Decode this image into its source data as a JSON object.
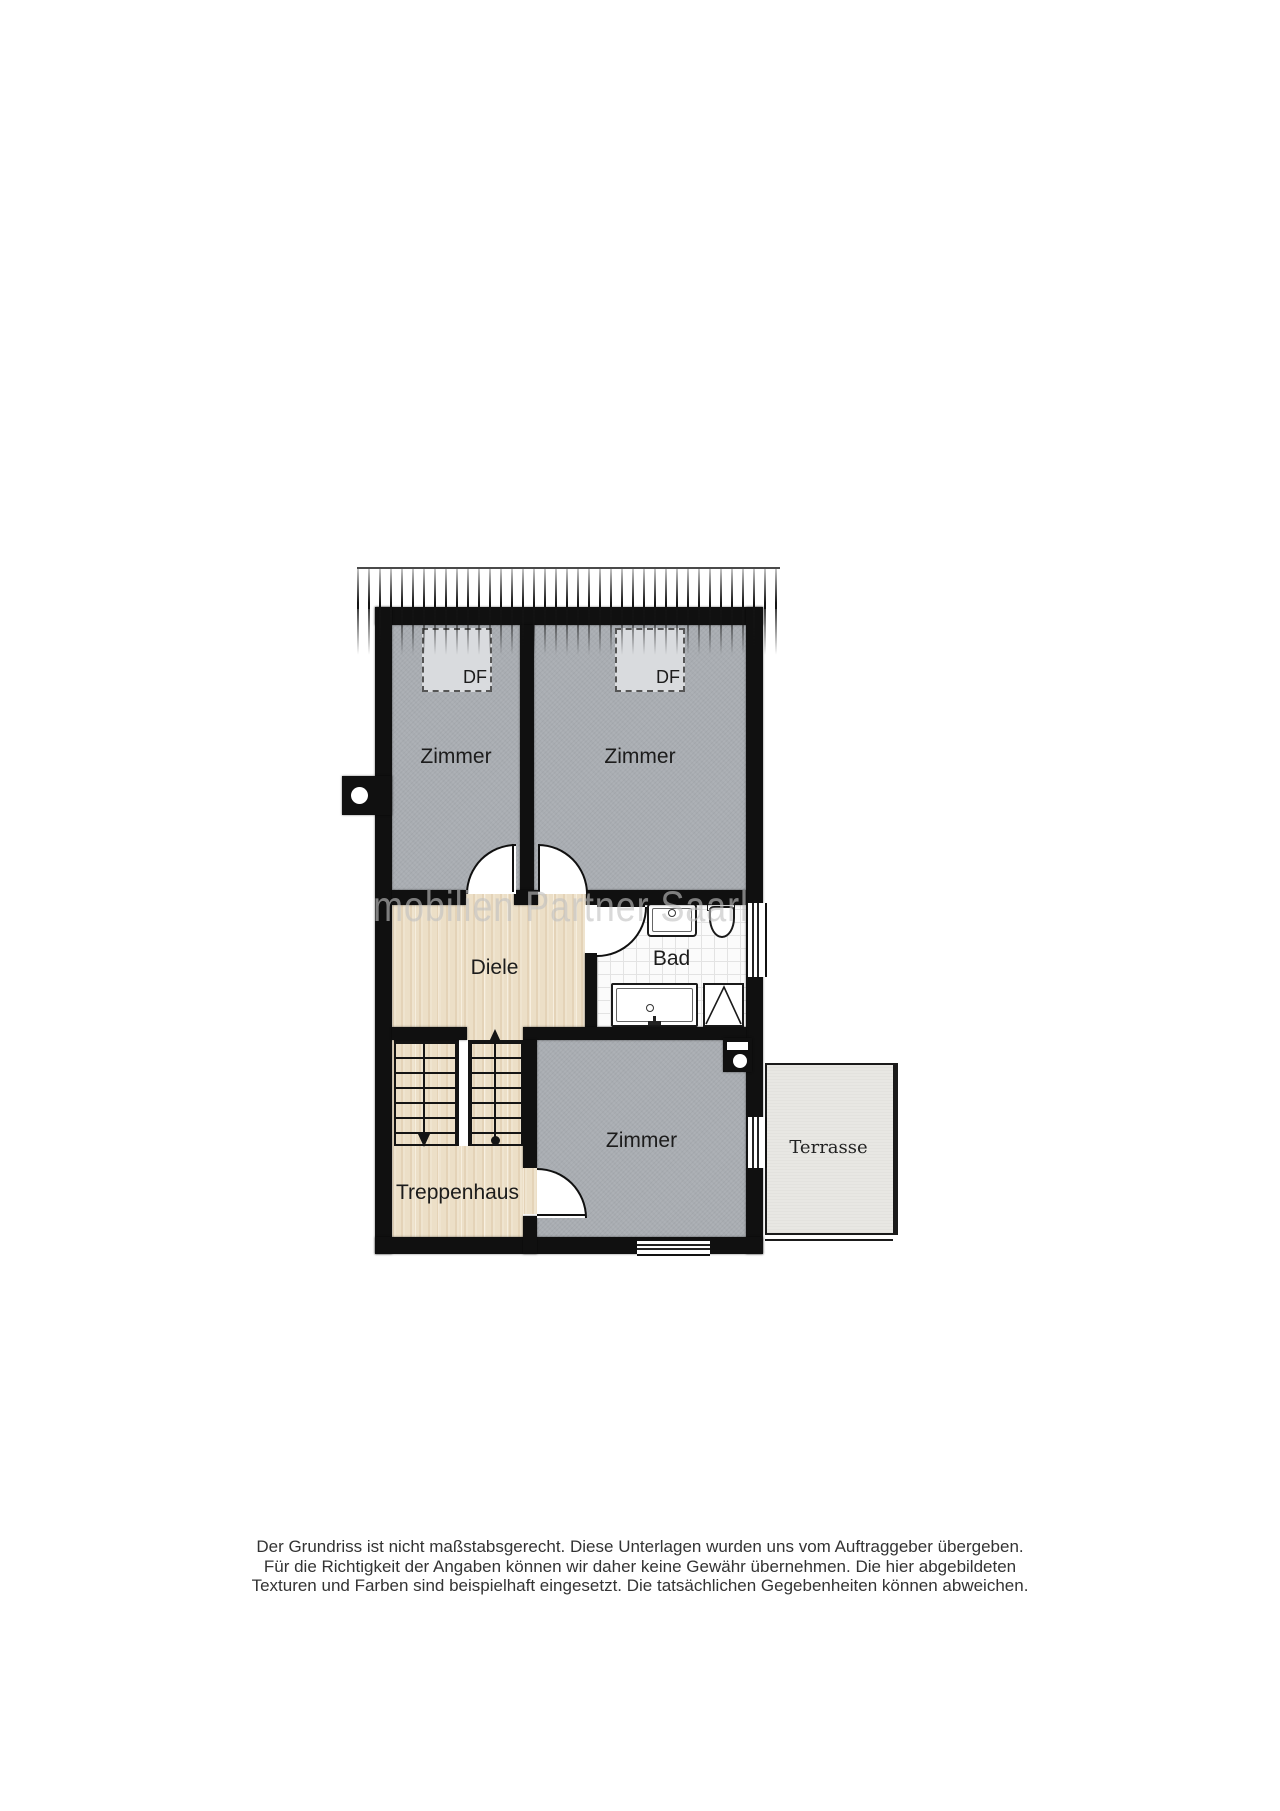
{
  "rooms": {
    "zimmer_top_left": "Zimmer",
    "zimmer_top_right": "Zimmer",
    "zimmer_bottom": "Zimmer",
    "diele": "Diele",
    "bad": "Bad",
    "treppenhaus": "Treppenhaus",
    "terrasse": "Terrasse"
  },
  "roof_windows": {
    "left": "DF",
    "right": "DF"
  },
  "watermark_text": "mobilien Partner Saarl",
  "disclaimer": {
    "line1": "Der Grundriss ist nicht maßstabsgerecht. Diese Unterlagen wurden uns vom Auftraggeber übergeben.",
    "line2": "Für die Richtigkeit der Angaben können wir daher keine Gewähr übernehmen. Die hier abgebildeten",
    "line3": "Texturen und Farben sind beispielhaft eingesetzt. Die tatsächlichen Gegebenheiten können abweichen."
  },
  "colors": {
    "wall": "#101010",
    "room": "#a9adb2",
    "wood": "#ecdfc7",
    "tile": "#fbfbfb",
    "terrace": "#e8e7e3",
    "watermark": "#c2c2c2"
  }
}
